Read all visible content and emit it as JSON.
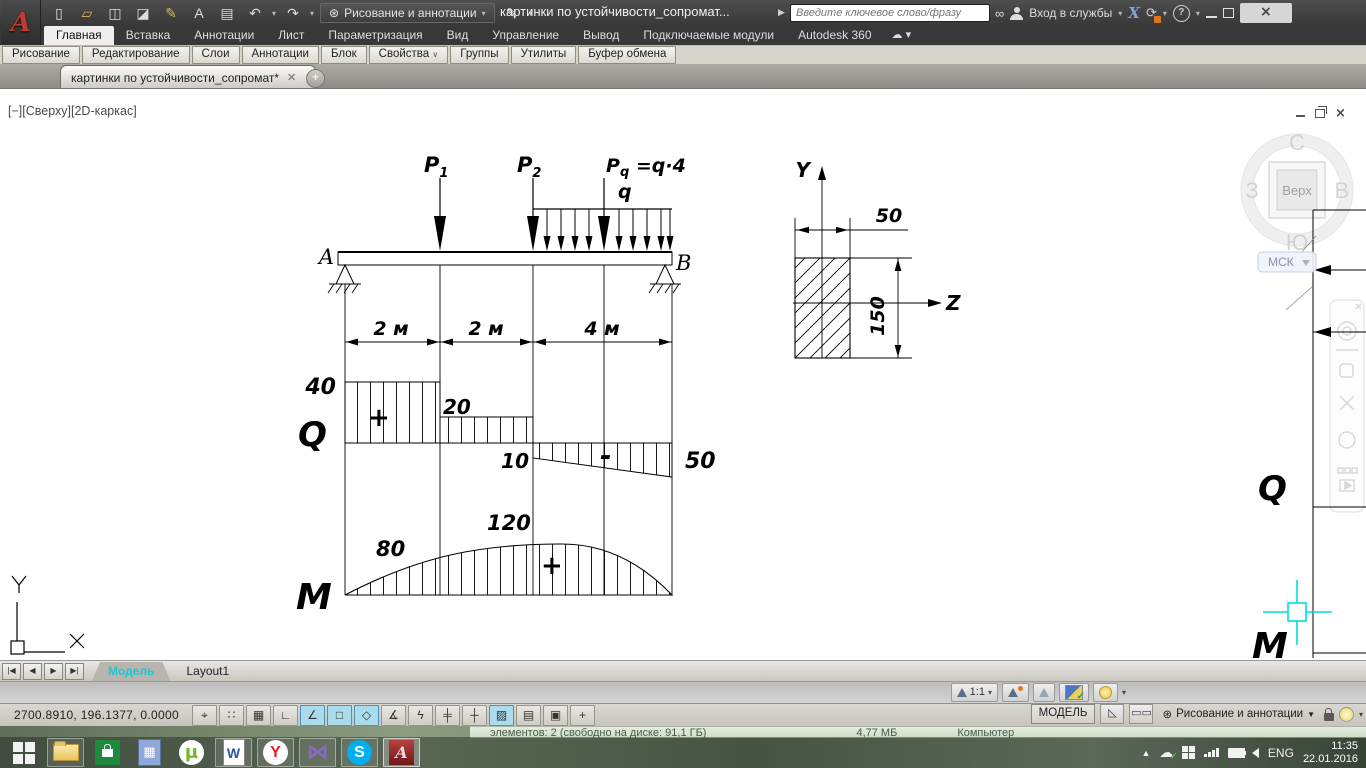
{
  "titlebar": {
    "logo_letter": "A",
    "qat": [
      {
        "name": "new-file",
        "glyph": "▯"
      },
      {
        "name": "open-file",
        "glyph": "▱"
      },
      {
        "name": "save",
        "glyph": "◫"
      },
      {
        "name": "save-as",
        "glyph": "◪"
      },
      {
        "name": "batch-plot",
        "glyph": "✎"
      },
      {
        "name": "text-tool",
        "glyph": "A"
      },
      {
        "name": "print",
        "glyph": "▤"
      },
      {
        "name": "undo",
        "glyph": "↶"
      },
      {
        "name": "redo",
        "glyph": "↷"
      }
    ],
    "workspace_label": "Рисование и аннотации",
    "doc_title": "картинки по устойчивости_сопромат...",
    "search_placeholder": "Введите ключевое слово/фразу",
    "signin_label": "Вход в службы",
    "exchange_letter": "X",
    "help_glyph": "?",
    "close_glyph": "×"
  },
  "ribbon": {
    "tabs": [
      {
        "label": "Главная"
      },
      {
        "label": "Вставка"
      },
      {
        "label": "Аннотации"
      },
      {
        "label": "Лист"
      },
      {
        "label": "Параметризация"
      },
      {
        "label": "Вид"
      },
      {
        "label": "Управление"
      },
      {
        "label": "Вывод"
      },
      {
        "label": "Подключаемые модули"
      },
      {
        "label": "Autodesk 360"
      }
    ],
    "cloud_glyph": "☁",
    "panels": [
      {
        "label": "Рисование"
      },
      {
        "label": "Редактирование"
      },
      {
        "label": "Слои"
      },
      {
        "label": "Аннотации"
      },
      {
        "label": "Блок"
      },
      {
        "label": "Свойства"
      },
      {
        "label": "Группы"
      },
      {
        "label": "Утилиты"
      },
      {
        "label": "Буфер обмена"
      }
    ]
  },
  "file_tab": {
    "title": "картинки по устойчивости_сопромат*",
    "close_glyph": "✕",
    "new_glyph": "+"
  },
  "viewport": {
    "label": "[−][Сверху][2D-каркас]"
  },
  "viewcube": {
    "north": "С",
    "west": "З",
    "east": "В",
    "south": "Ю",
    "face": "Верх",
    "ucs": "МСК"
  },
  "drawing": {
    "support_left": "A",
    "support_right": "B",
    "load1": "P",
    "load1_sub": "1",
    "load2": "P",
    "load2_sub": "2",
    "load3": "P",
    "load3_sub": "q",
    "load3_eq": " =q·4",
    "dist_load": "q",
    "dim1": "2 м",
    "dim2": "2 м",
    "dim3": "4 м",
    "q_label": "Q",
    "q_v1": "40",
    "q_v2": "20",
    "q_v3": "10",
    "q_v4": "50",
    "q_plus": "+",
    "q_minus": "-",
    "m_label": "M",
    "m_v1": "80",
    "m_v2": "120",
    "m_plus": "+",
    "sec_y": "Y",
    "sec_z": "Z",
    "sec_w": "50",
    "sec_h": "150",
    "side_q": "Q",
    "side_m": "M",
    "ucs_x": "X",
    "ucs_y": "Y"
  },
  "model_bar": {
    "model_tab": "Модель",
    "layout_tab": "Layout1"
  },
  "status_bar": {
    "coordinates": "2700.8910, 196.1377, 0.0000",
    "toggles": [
      {
        "glyph": "⌖",
        "active": false
      },
      {
        "glyph": "∷",
        "active": false
      },
      {
        "glyph": "▦",
        "active": false
      },
      {
        "glyph": "∟",
        "active": false
      },
      {
        "glyph": "∠",
        "active": true
      },
      {
        "glyph": "□",
        "active": true
      },
      {
        "glyph": "◇",
        "active": true
      },
      {
        "glyph": "∡",
        "active": false
      },
      {
        "glyph": "ϟ",
        "active": false
      },
      {
        "glyph": "╪",
        "active": false
      },
      {
        "glyph": "┼",
        "active": false
      },
      {
        "glyph": "▨",
        "active": true
      },
      {
        "glyph": "▤",
        "active": false
      },
      {
        "glyph": "▣",
        "active": false
      },
      {
        "glyph": "+",
        "active": false
      }
    ],
    "annotation_scale": "1:1",
    "model_button": "МОДЕЛЬ",
    "workspace_label": "Рисование и аннотации"
  },
  "background_window": {
    "items": "элементов: 2 (свободно на диске: 91,1 ГБ)",
    "size": "4,77 МБ",
    "computer": "Компьютер"
  },
  "taskbar": {
    "calc_glyph": "▦",
    "utorrent_letter": "µ",
    "word_letter": "W",
    "yandex_letter": "Y",
    "kmplayer_glyph": "⋈",
    "skype_letter": "S",
    "autocad_letter": "A",
    "language": "ENG",
    "time": "11:35",
    "date": "22.01.2016"
  }
}
